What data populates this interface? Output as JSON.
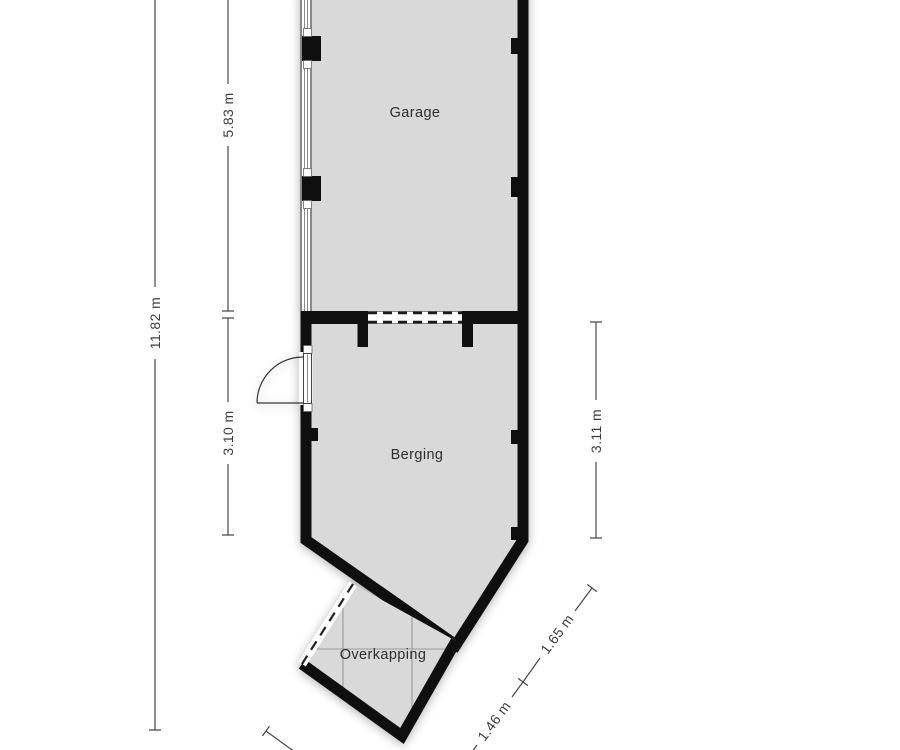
{
  "floorplan": {
    "rooms": [
      {
        "id": "garage",
        "label": "Garage"
      },
      {
        "id": "berging",
        "label": "Berging"
      },
      {
        "id": "overkapping",
        "label": "Overkapping"
      }
    ],
    "dimensions": {
      "total_left": {
        "label": "11.82 m"
      },
      "garage_left": {
        "label": "5.83 m"
      },
      "berging_left": {
        "label": "3.10 m"
      },
      "berging_right": {
        "label": "3.11 m"
      },
      "berging_diagonal": {
        "label": "1.65 m"
      },
      "overkapping_diagonal": {
        "label": "1.46 m"
      }
    },
    "colors": {
      "room_fill": "#d9d9d9",
      "wall": "#0f0f0f",
      "dimension_line": "#474747",
      "label_text": "#2e2e2e",
      "roof_line": "#9a9a9a"
    }
  }
}
